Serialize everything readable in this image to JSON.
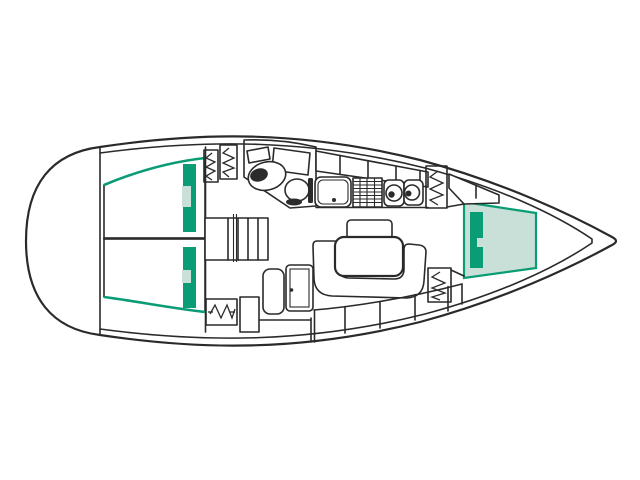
{
  "diagram": {
    "kind": "sailboat-interior-deck-plan",
    "orientation": "bow-right-stern-left",
    "parts": [
      "hull-outline",
      "inner-deck-line",
      "transom",
      "aft-bulkhead",
      "aft-cabin-berth-port",
      "aft-cabin-berth-starboard",
      "berth-divider",
      "forward-v-berth",
      "berth-cushions",
      "head-compartment",
      "washbasin",
      "toilet",
      "head-door",
      "galley-sink",
      "galley-grill",
      "galley-burners",
      "galley-shelf-band",
      "companionway-steps",
      "hanging-lockers",
      "salon-u-settee",
      "salon-table",
      "settee-backrest",
      "nav-seat",
      "chart-table",
      "hull-side-lockers"
    ]
  },
  "colors": {
    "outline": "#2a2a2a",
    "background": "#ffffff",
    "berth_fill": "#c8e0d8",
    "berth_accent": "#0a9c74",
    "head_fill": "#f1d190",
    "locker_fill": "#f5efd5",
    "settee_fill": "#aa8148",
    "dark_detail": "#2b2b2b"
  }
}
